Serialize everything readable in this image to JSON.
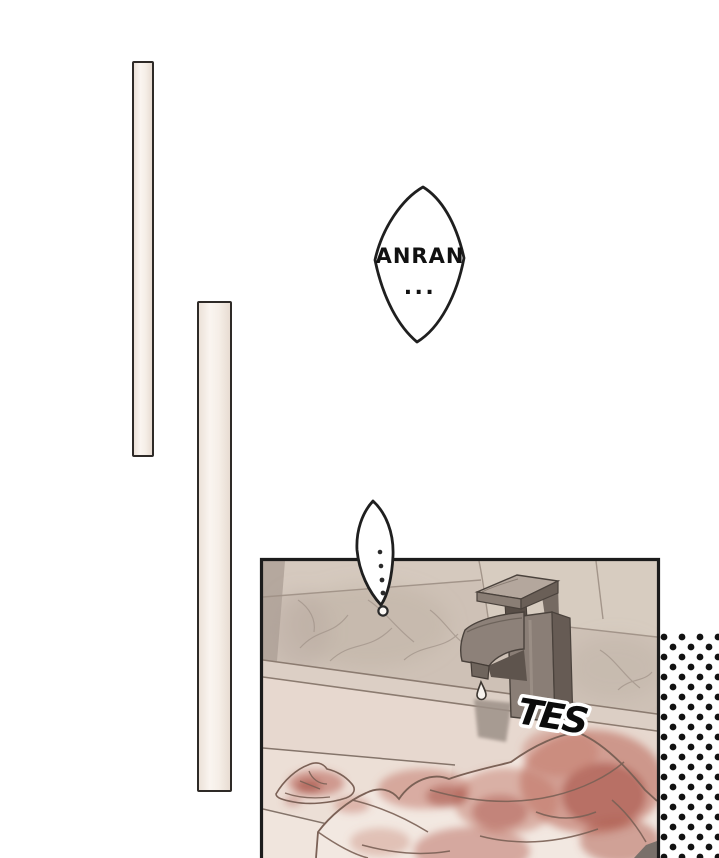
{
  "page": {
    "kind": "manga-page-segment",
    "background_color": "#ffffff"
  },
  "speech": {
    "anran_bubble": {
      "line1": "ANRAN",
      "line2": "..."
    },
    "pause_bubble": {
      "text": "..."
    }
  },
  "sfx": {
    "drip": "TES"
  },
  "colors": {
    "panel_border": "#1c1c1c",
    "tile_wall": "#cec1b6",
    "counter": "#e7d8cf",
    "blood_stain": "#a84b40",
    "halftone_dot": "#121212",
    "faucet_metal": "#8a7e76"
  },
  "illustrations": {
    "panel": "bathroom-counter-with-dripping-faucet",
    "faucet": "dripping-faucet",
    "towel": "blood-stained-towel",
    "halftone": "halftone-dot-pattern",
    "spacer_bars": "two-vertical-panel-bars"
  }
}
